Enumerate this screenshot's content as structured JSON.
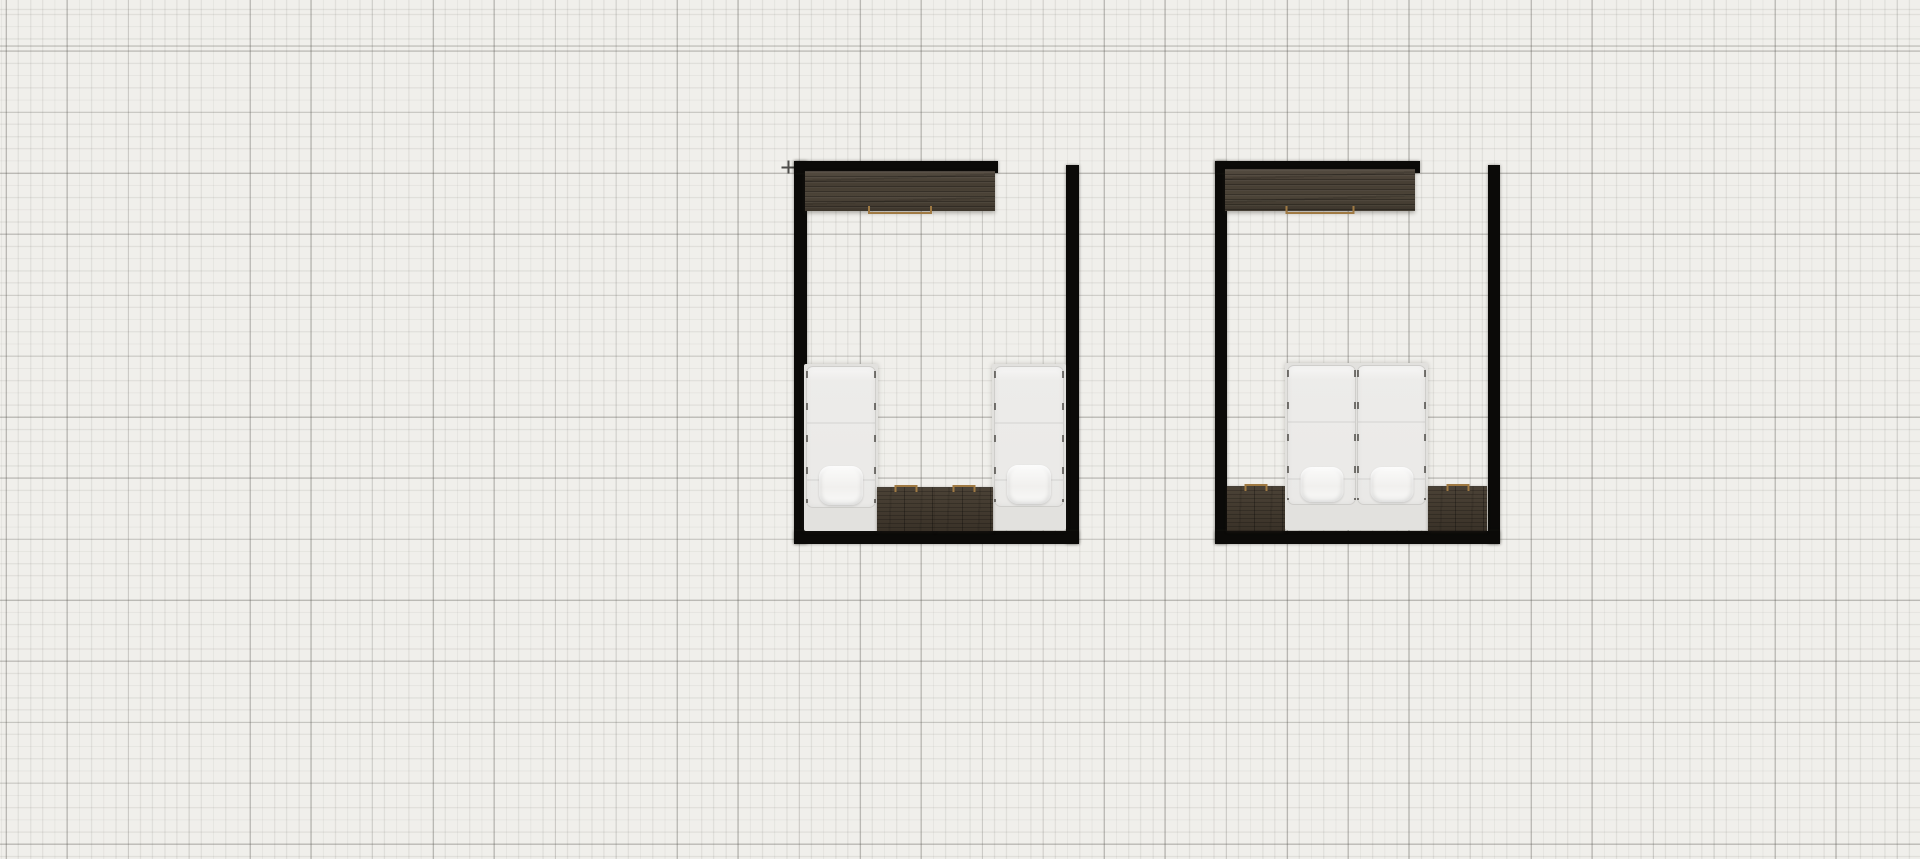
{
  "app": {
    "view": "floor-plan-canvas",
    "visible_text": []
  },
  "colors": {
    "canvas_bg": "#f0efeb",
    "grid_minor": "rgba(80,78,72,0.10)",
    "grid_major": "rgba(80,78,72,0.30)",
    "wall": "#0b0a08",
    "wood_dark": "#46403a",
    "handle_tan": "#a07a43",
    "bed_frame": "#e2e1de",
    "mattress": "#edecea",
    "pillow": "#f9f9f8",
    "cursor": "#4d4c4a"
  },
  "cursor": {
    "icon": "crosshair-icon",
    "x": 788,
    "y": 167
  },
  "scene": {
    "rooms": [
      {
        "name": "twin-bedroom",
        "walls": [
          {
            "side": "left",
            "x": 794,
            "y": 161,
            "w": 13,
            "h": 383
          },
          {
            "side": "top",
            "x": 794,
            "y": 161,
            "w": 204,
            "h": 12
          },
          {
            "side": "right",
            "x": 1066,
            "y": 165,
            "w": 13,
            "h": 379
          },
          {
            "side": "bottom",
            "x": 794,
            "y": 531,
            "w": 285,
            "h": 13
          }
        ],
        "furniture": [
          {
            "type": "wardrobe",
            "x": 805,
            "y": 171,
            "w": 190,
            "h": 40,
            "handle_w": 60
          },
          {
            "type": "bed-single",
            "x": 804,
            "y": 364,
            "w": 74,
            "h": 167
          },
          {
            "type": "bed-single",
            "x": 992,
            "y": 364,
            "w": 74,
            "h": 166
          },
          {
            "type": "nightstand",
            "x": 877,
            "y": 487,
            "w": 58,
            "h": 44
          },
          {
            "type": "nightstand",
            "x": 935,
            "y": 487,
            "w": 58,
            "h": 44
          }
        ]
      },
      {
        "name": "double-bedroom",
        "walls": [
          {
            "side": "left",
            "x": 1215,
            "y": 161,
            "w": 12,
            "h": 383
          },
          {
            "side": "top",
            "x": 1215,
            "y": 161,
            "w": 205,
            "h": 12
          },
          {
            "side": "right",
            "x": 1488,
            "y": 165,
            "w": 12,
            "h": 379
          },
          {
            "side": "bottom",
            "x": 1215,
            "y": 531,
            "w": 285,
            "h": 13
          }
        ],
        "furniture": [
          {
            "type": "wardrobe",
            "x": 1225,
            "y": 169,
            "w": 190,
            "h": 42,
            "handle_w": 65
          },
          {
            "type": "nightstand",
            "x": 1227,
            "y": 486,
            "w": 58,
            "h": 45
          },
          {
            "type": "bed-double",
            "x": 1285,
            "y": 363,
            "w": 143,
            "h": 167
          },
          {
            "type": "nightstand",
            "x": 1428,
            "y": 486,
            "w": 59,
            "h": 45
          }
        ]
      }
    ]
  }
}
